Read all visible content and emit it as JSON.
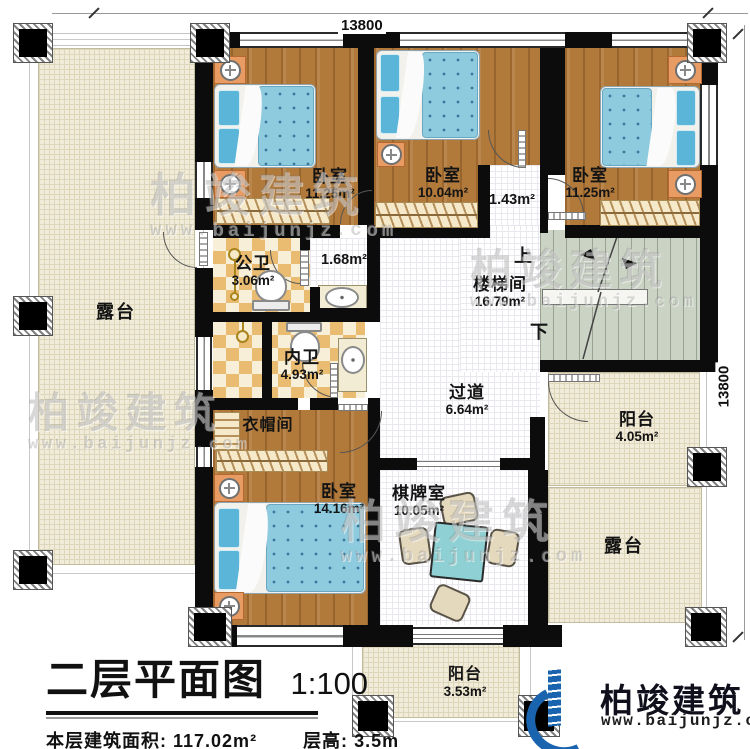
{
  "dimensions": {
    "top": "13800",
    "right": "13800"
  },
  "rooms": {
    "bedroom_tl": {
      "name": "卧室",
      "area": "11.25m²"
    },
    "bedroom_tm": {
      "name": "卧室",
      "area": "10.04m²"
    },
    "bedroom_tr": {
      "name": "卧室",
      "area": "11.25m²"
    },
    "hall_small": {
      "area": "1.43m²"
    },
    "hall_bath": {
      "area": "1.68m²"
    },
    "bath_public": {
      "name": "公卫",
      "area": "3.06m²"
    },
    "bath_private": {
      "name": "内卫",
      "area": "4.93m²"
    },
    "stairwell": {
      "name": "楼梯间",
      "area": "16.79m²"
    },
    "corridor": {
      "name": "过道",
      "area": "6.64m²"
    },
    "cloakroom": {
      "name": "衣帽间"
    },
    "bedroom_b": {
      "name": "卧室",
      "area": "14.16m²"
    },
    "chess_room": {
      "name": "棋牌室",
      "area": "10.05m²"
    },
    "terrace_left": {
      "name": "露台"
    },
    "terrace_right": {
      "name": "露台"
    },
    "balcony_right": {
      "name": "阳台",
      "area": "4.05m²"
    },
    "balcony_bottom": {
      "name": "阳台",
      "area": "3.53m²"
    }
  },
  "stairs": {
    "up": "上",
    "down": "下"
  },
  "title": {
    "main": "二层平面图",
    "scale": "1:100",
    "area_label": "本层建筑面积:",
    "area_value": "117.02m²",
    "height_label": "层高:",
    "height_value": "3.5m"
  },
  "logo": {
    "name": "柏竣建筑",
    "url": "www.baijunjz.com"
  },
  "watermark": {
    "name": "柏竣建筑",
    "url": "www.baijunjz.com"
  },
  "colors": {
    "wall": "#0c0c0c",
    "wood_floor": "#b1793a",
    "bed": "#8fcbdf",
    "terrace": "#f1ecd9",
    "stairs": "#cbd3c5",
    "tile": "#e9bc72",
    "logo_blue": "#1a63ae",
    "logo_orange": "#f7a823"
  }
}
